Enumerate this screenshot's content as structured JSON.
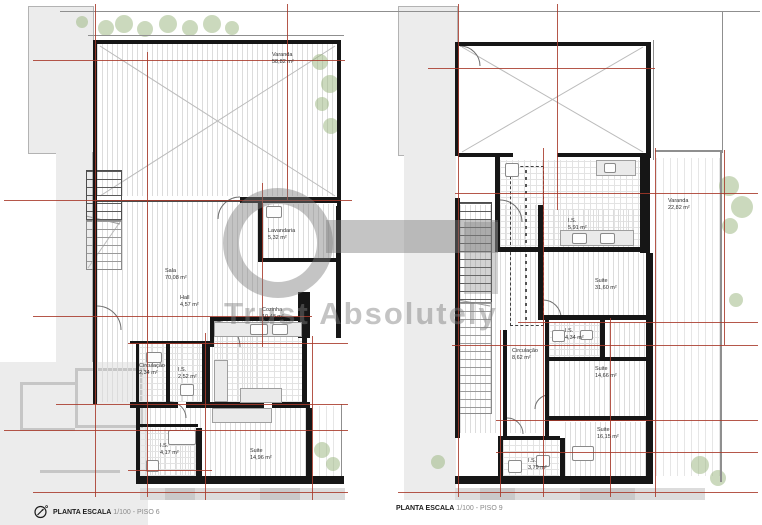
{
  "watermark": {
    "text": "Trust Absolutely"
  },
  "colors": {
    "wall": "#161616",
    "red": "#a8392a",
    "ctx": "#ececec",
    "hatchline": "#dcdcdc",
    "wm": "rgba(125,125,125,0.45)"
  },
  "plans": {
    "piso6": {
      "footer_label": "PLANTA ESCALA",
      "footer_scale": "1/100 - PISO 6",
      "rooms": [
        {
          "name": "Varanda",
          "area": "58,82 m²"
        },
        {
          "name": "Lavandaria",
          "area": "5,32 m²"
        },
        {
          "name": "Sala",
          "area": "70,08 m²"
        },
        {
          "name": "Hall",
          "area": "4,57 m²"
        },
        {
          "name": "Cozinha",
          "area": "10,48 m²"
        },
        {
          "name": "Circulação",
          "area": "2,34 m²"
        },
        {
          "name": "I.S.",
          "area": "2,52 m²"
        },
        {
          "name": "I.S.",
          "area": "4,17 m²"
        },
        {
          "name": "Suite",
          "area": "14,96 m²"
        }
      ]
    },
    "piso9": {
      "footer_label": "PLANTA ESCALA",
      "footer_scale": "1/100 - PISO 9",
      "rooms": [
        {
          "name": "I.S.",
          "area": "5,91 m²"
        },
        {
          "name": "Varanda",
          "area": "22,82 m²"
        },
        {
          "name": "Suite",
          "area": "31,60 m²"
        },
        {
          "name": "I.S.",
          "area": "4,34 m²"
        },
        {
          "name": "Circulação",
          "area": "8,62 m²"
        },
        {
          "name": "Suite",
          "area": "14,66 m²"
        },
        {
          "name": "Suite",
          "area": "16,15 m²"
        },
        {
          "name": "I.S.",
          "area": "3,79 m²"
        }
      ]
    }
  }
}
